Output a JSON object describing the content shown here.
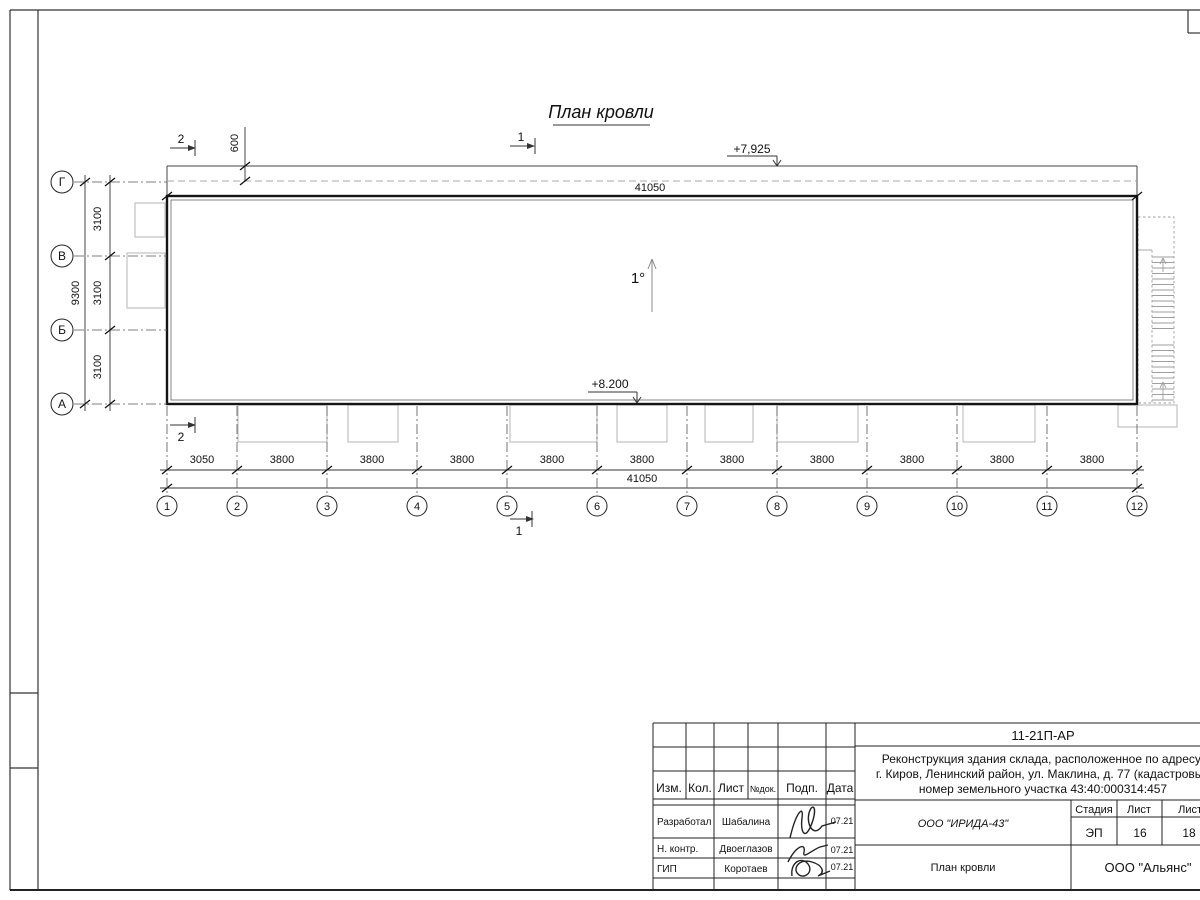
{
  "drawing": {
    "title": "План кровли",
    "slope_label": "1°",
    "elevation_high": "+7,925",
    "elevation_low": "+8.200",
    "dim_600": "600",
    "dim_total": "41050",
    "section_mark_1": "1",
    "section_mark_2": "2",
    "axes_bottom": [
      "1",
      "2",
      "3",
      "4",
      "5",
      "6",
      "7",
      "8",
      "9",
      "10",
      "11",
      "12"
    ],
    "axes_left": [
      "Г",
      "В",
      "Б",
      "А"
    ],
    "dims_bottom": [
      "3050",
      "3800",
      "3800",
      "3800",
      "3800",
      "3800",
      "3800",
      "3800",
      "3800",
      "3800",
      "3800"
    ],
    "dims_left": [
      "3100",
      "3100",
      "3100"
    ],
    "dim_left_total": "9300"
  },
  "title_block": {
    "doc_code": "11-21П-АР",
    "project": [
      "Реконструкция здания склада, расположенное по адресу:",
      "г. Киров, Ленинский район, ул. Маклина, д. 77 (кадастровый",
      "номер земельного участка 43:40:000314:457"
    ],
    "col_izm": "Изм.",
    "col_kol": "Кол.",
    "col_list": "Лист",
    "col_ndok": "№док.",
    "col_podp": "Подп.",
    "col_data": "Дата",
    "stage_label": "Стадия",
    "sheet_label": "Лист",
    "sheets_label": "Листов",
    "stage": "ЭП",
    "sheet_no": "16",
    "sheets_total": "18",
    "designer_org": "ООО \"ИРИДА-43\"",
    "sheet_title": "План кровли",
    "customer_org": "ООО \"Альянс\"",
    "rows": [
      {
        "role": "Разработал",
        "name": "Шабалина",
        "date": "07.21"
      },
      {
        "role": "Н. контр.",
        "name": "Двоеглазов",
        "date": "07.21"
      },
      {
        "role": "ГИП",
        "name": "Коротаев",
        "date": "07.21"
      }
    ],
    "colors": {
      "line": "#222222",
      "gray": "#9e9e9e",
      "paper": "#ffffff"
    }
  }
}
